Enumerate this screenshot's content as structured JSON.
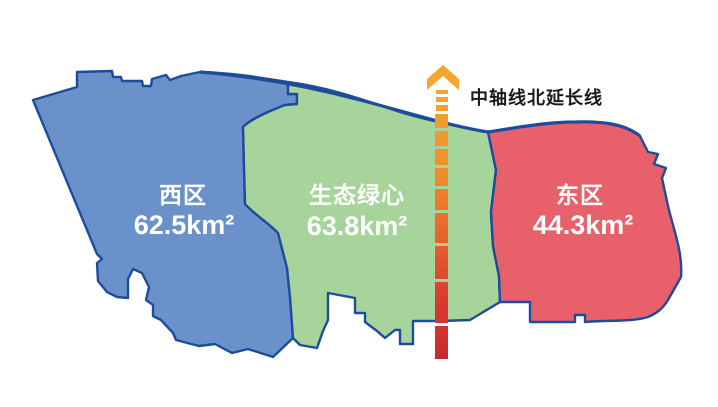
{
  "map": {
    "regions": [
      {
        "name": "西区",
        "area": "62.5km²",
        "fill": "#6b91cb"
      },
      {
        "name": "生态绿心",
        "area": "63.8km²",
        "fill": "#a6d49b"
      },
      {
        "name": "东区",
        "area": "44.3km²",
        "fill": "#e8606a"
      }
    ],
    "axis": {
      "label": "中轴线北延长线",
      "gradient_stops": [
        "#f4a62f",
        "#ef8e2d",
        "#e6632e",
        "#d83b30",
        "#c9292f"
      ]
    },
    "colors": {
      "border": "#1d4c9c",
      "background": "#ffffff",
      "region_label": "#ffffff",
      "axis_label": "#1a1a1a"
    }
  }
}
